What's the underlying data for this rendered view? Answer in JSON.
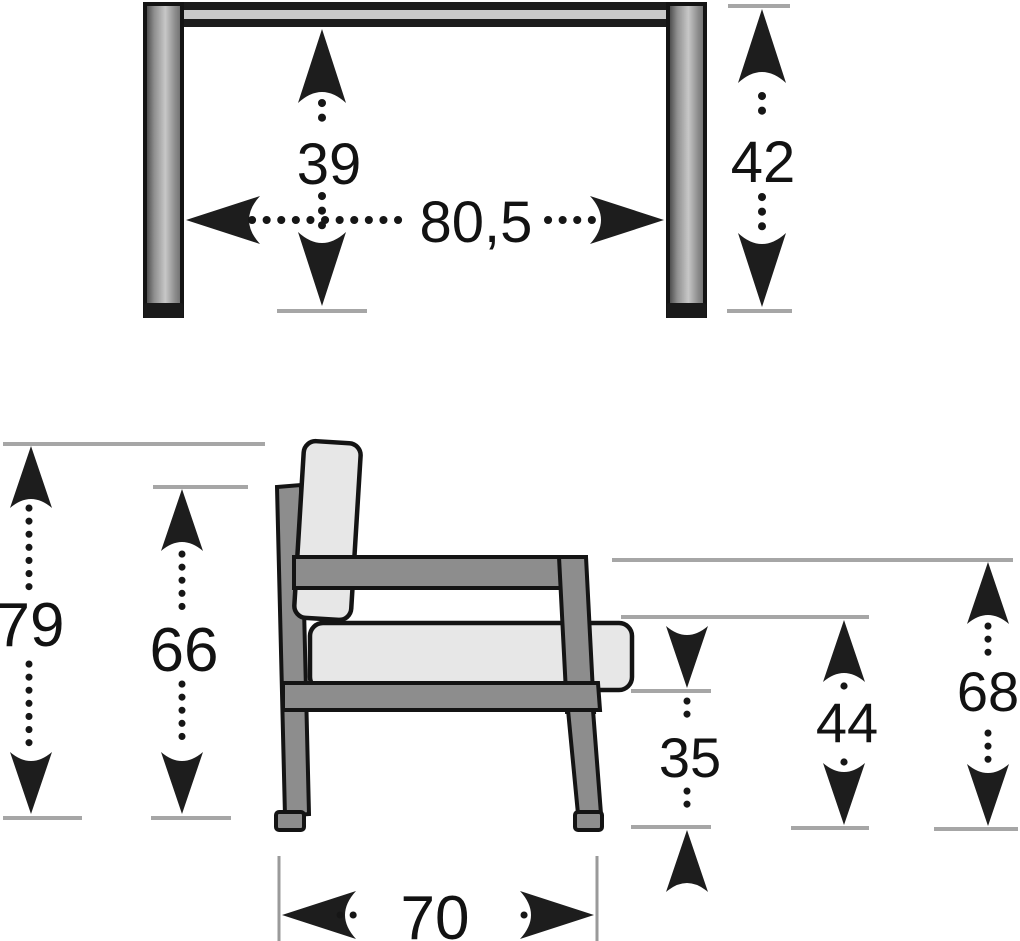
{
  "diagram": {
    "title": "furniture-dimension-diagram",
    "top_view": {
      "inner_height": "39",
      "inner_width": "80,5",
      "leg_height": "42"
    },
    "side_view": {
      "total_height": "79",
      "back_height": "66",
      "under_seat_height": "35",
      "seat_height": "44",
      "arm_height": "68",
      "depth": "70"
    },
    "colors": {
      "outline": "#141414",
      "arrow_text": "#1d1d1d",
      "frame_gray": "#8d8d8d",
      "cushion_gray": "#e7e7e7",
      "extension_line_gray": "#a6a6a6",
      "rail_stripe": "#c9c9c9",
      "background": "#ffffff"
    }
  }
}
